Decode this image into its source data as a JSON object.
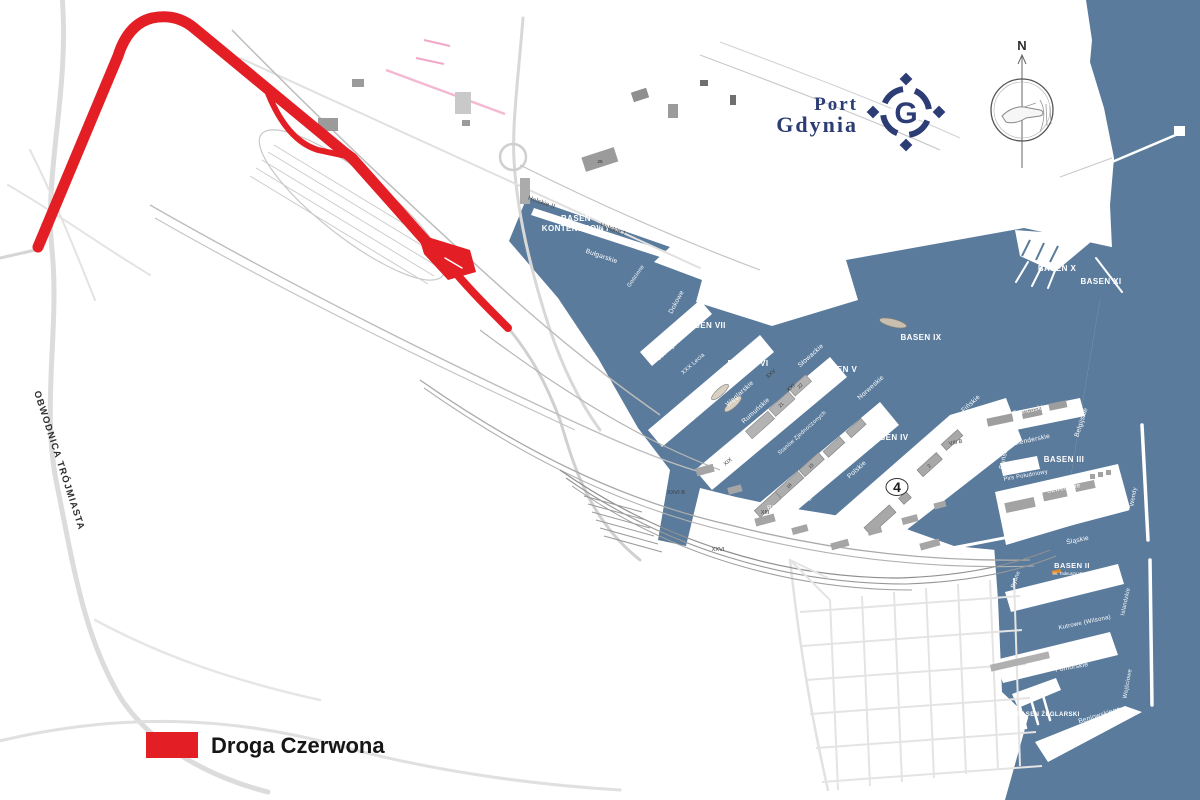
{
  "legend": {
    "label": "Droga Czerwona",
    "swatch_color": "#e31e24"
  },
  "logo": {
    "line1": "Port",
    "line2": "Gdynia",
    "letter": "G",
    "color": "#2c3c74"
  },
  "compass": {
    "north": "N"
  },
  "ring_road": {
    "label": "OBWODNICA TRÓJMIASTA"
  },
  "colors": {
    "water": "#5a7b9c",
    "red_road": "#e31e24",
    "rail_gray": "#b5b5b5",
    "building_gray": "#9b9b9b"
  },
  "basins": {
    "kontenerowy_line1": "BASEN",
    "kontenerowy_line2": "KONTENEROWY",
    "viii": "BASEN VIII",
    "vii": "BASEN VII",
    "vi": "BASEN VI",
    "v": "BASEN V",
    "iv": "BASEN IV",
    "iii": "BASEN III",
    "ii": "BASEN II",
    "ii_sub": "im. Tadeusza Wendy",
    "i": "BASEN I",
    "i_sub": "Prezydenta",
    "ix": "BASEN IX",
    "x": "BASEN X",
    "xi": "BASEN XI",
    "zeglarski": "BASEN ŻEGLARSKI"
  },
  "quays": {
    "helskie2": "Helskie II",
    "helskie1": "Helskie I",
    "bulgarskie": "Bułgarskie",
    "oksywskie": "Oksywskie",
    "dokowe": "Dokowe",
    "goscinne": "Gościnne",
    "suchego_doku": "Suchego Doku",
    "xxx_lecia": "XXX Lecia",
    "albanskie": "Albańskie",
    "weglarskie": "Węglarskie",
    "rumunskie": "Rumuńskie",
    "czeskie": "Czeskie",
    "slowackie": "Słowackie",
    "norweskie": "Norweskie",
    "stanow_zjednoczonych": "Stanów Zjednoczonych",
    "indyjskie": "Indyjskie",
    "polskie": "Polskie",
    "rotterdamskie": "Rotterdamskie",
    "finskie": "Fińskie",
    "francuskie": "Francuskie",
    "belgijskie": "Belgijskie",
    "holenderskie": "Holenderskie",
    "dunskie": "Duńskie",
    "pirs_poludniowy": "Pirs Południowy",
    "szwedzkie": "Szwedzkie",
    "wendy": "Wendy",
    "slaskie": "Śląskie",
    "rybne": "Rybne",
    "angielskie": "Angielskie",
    "islandzkie": "Islandzkie",
    "kutrowe": "Kutrowe (Wilsona)",
    "pomorskie": "Pomorskie",
    "wejsciowe": "Wejściowe",
    "beniowskiego": "Beniowskiego"
  },
  "piers": {
    "xxv": "XXV",
    "xxi": "XXI",
    "xix": "XIX",
    "xiii": "XIII",
    "xxvi": "XXVI",
    "xxvi_b": "XXVI B",
    "viii_b": "VIII B"
  },
  "numbers": {
    "n25": "25",
    "n21": "21",
    "n22": "22",
    "n18": "18",
    "n15": "15",
    "n2": "2",
    "pier4_marker": "4"
  }
}
